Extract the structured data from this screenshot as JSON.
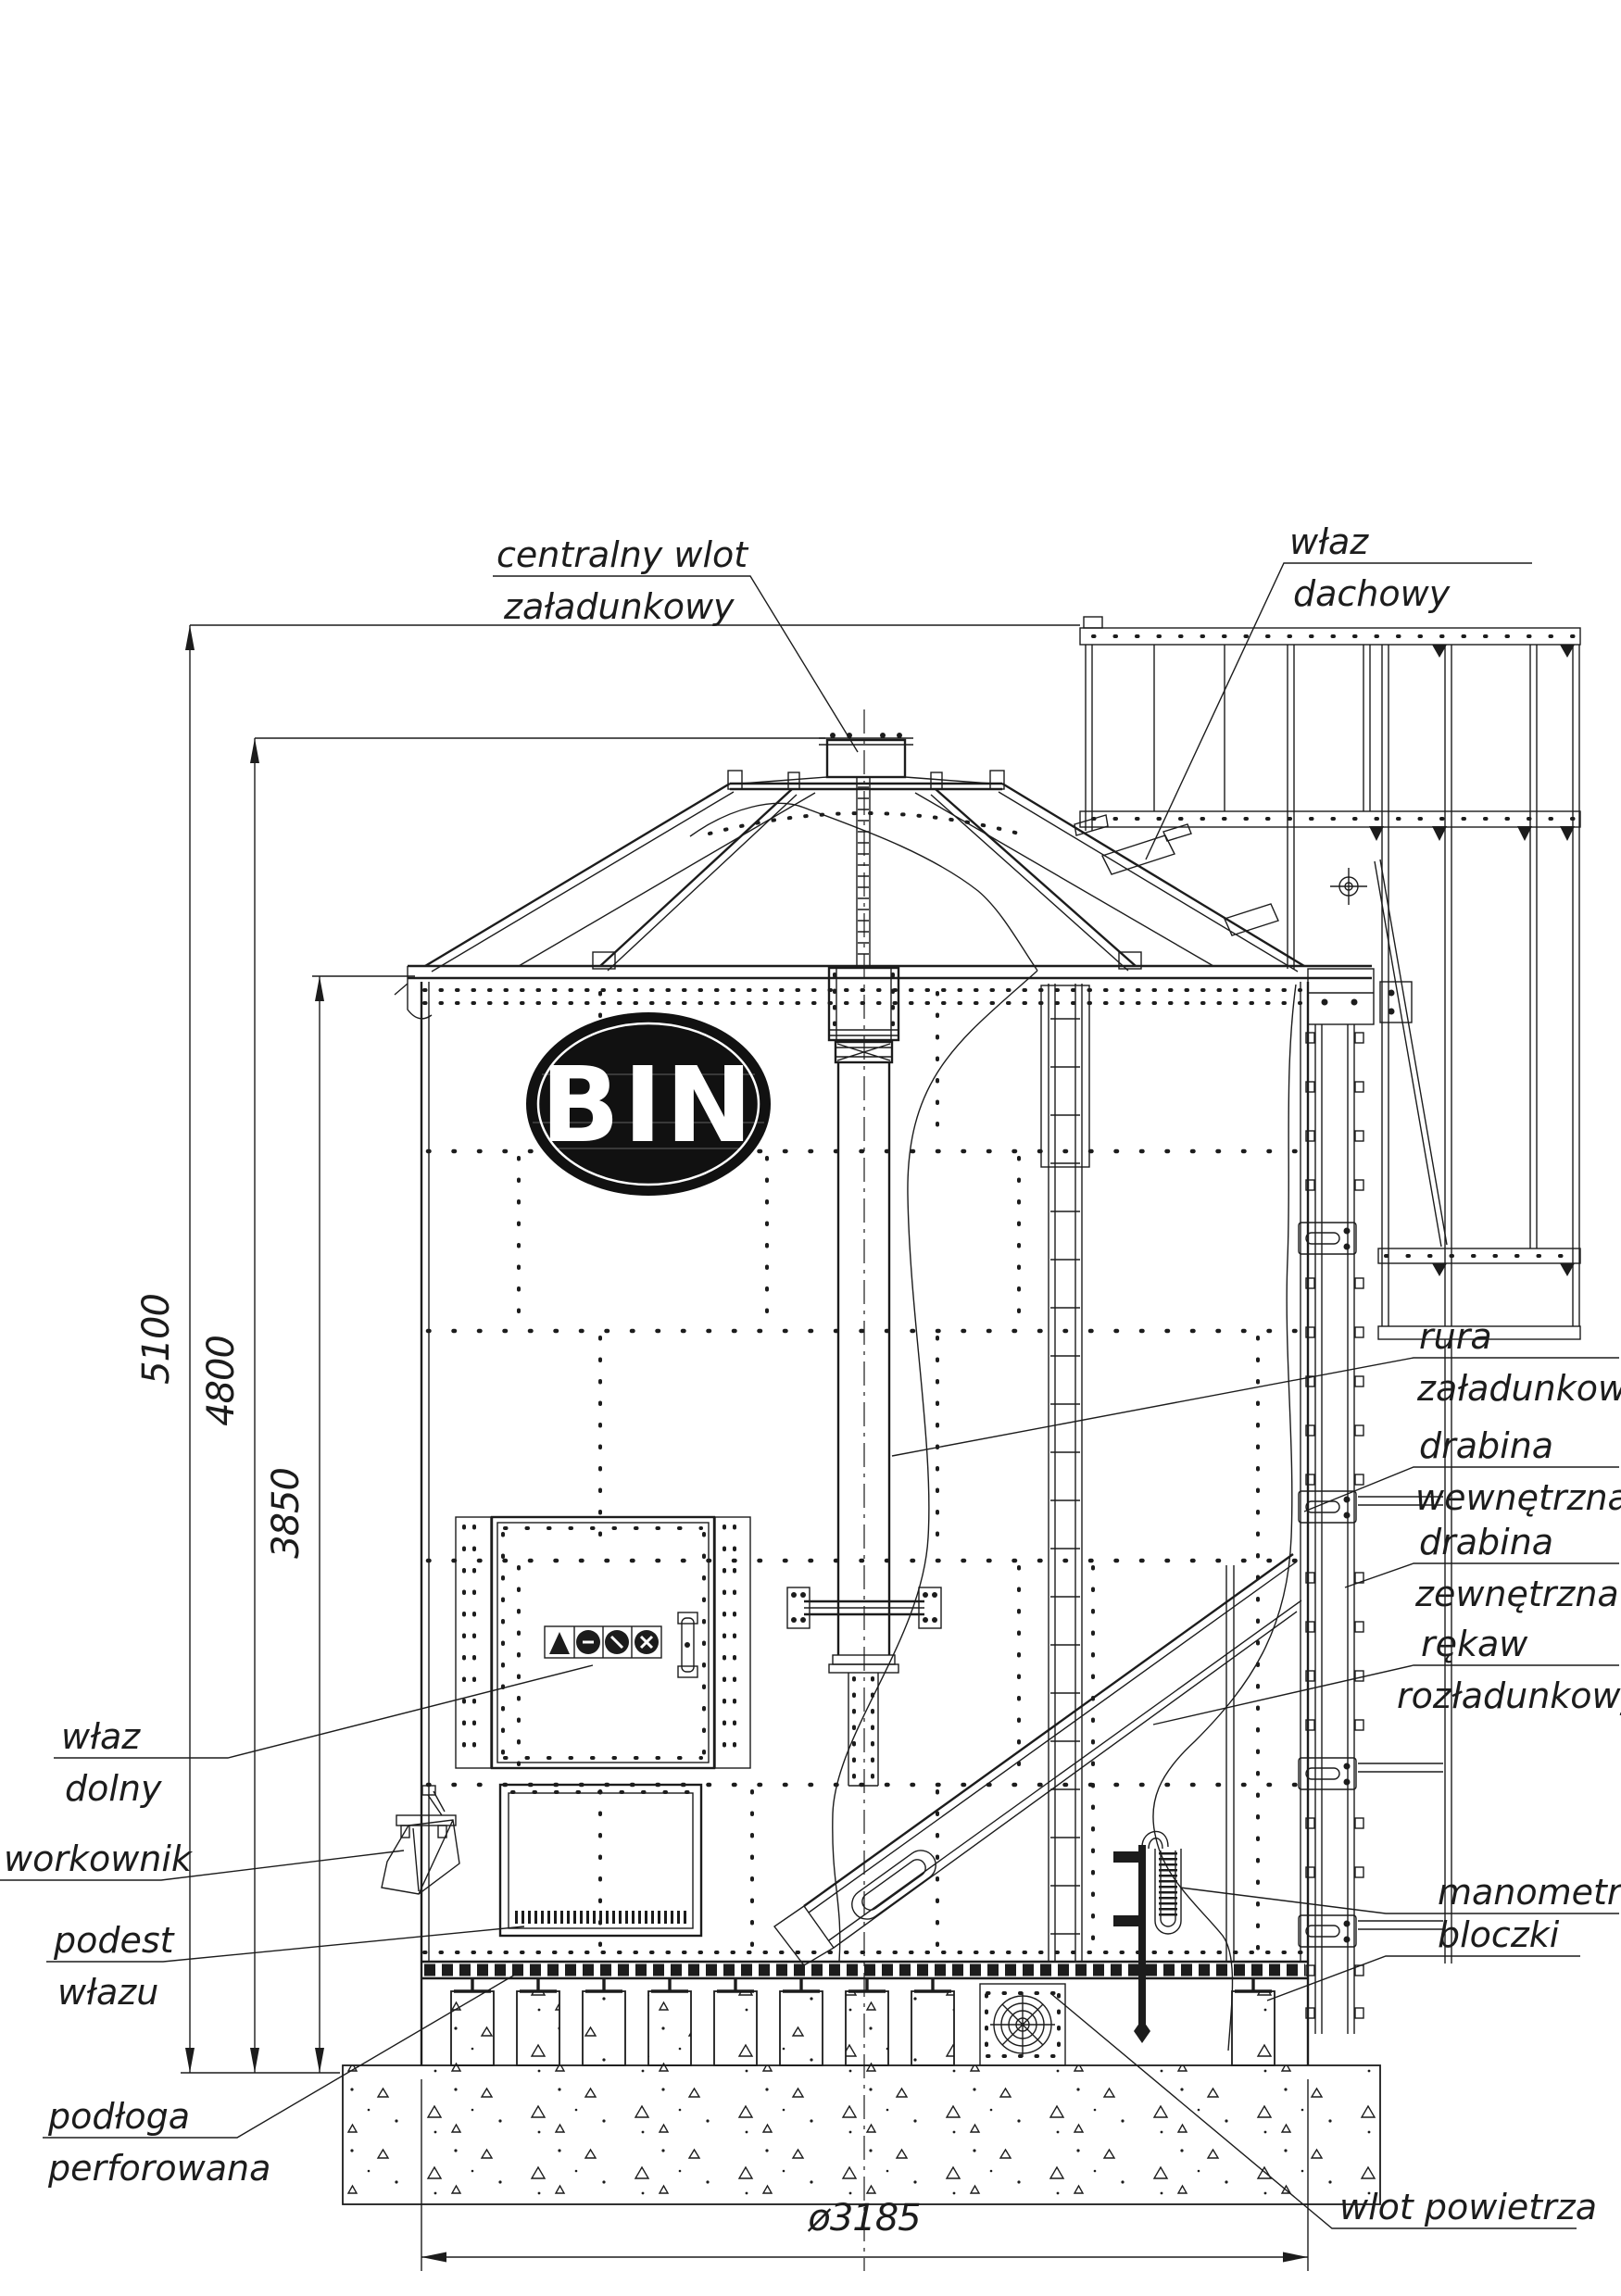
{
  "drawing": {
    "type": "technical-elevation-drawing",
    "subject": "BIN grain silo with dryer equipment, side elevation with partial cutaway",
    "logo_text": "BIN"
  },
  "labels": {
    "centralny_wlot": {
      "line1": "centralny wlot",
      "line2": "załadunkowy"
    },
    "wlaz_dachowy": {
      "line1": "właz",
      "line2": "dachowy"
    },
    "rura_zaladunkowa": {
      "line1": "rura",
      "line2": "załadunkowa"
    },
    "drabina_wewnetrzna": {
      "line1": "drabina",
      "line2": "wewnętrzna"
    },
    "drabina_zewnetrzna": {
      "line1": "drabina",
      "line2": "zewnętrzna"
    },
    "rekaw_rozladunkowy": {
      "line1": "rękaw",
      "line2": "rozładunkowy"
    },
    "manometr": {
      "line1": "manometr"
    },
    "bloczki": {
      "line1": "bloczki"
    },
    "wlot_powietrza": {
      "line1": "wlot powietrza"
    },
    "wlaz_dolny": {
      "line1": "właz",
      "line2": "dolny"
    },
    "workownik": {
      "line1": "workownik"
    },
    "podest_wlazu": {
      "line1": "podest",
      "line2": "włazu"
    },
    "podloga_perforowana": {
      "line1": "podłoga",
      "line2": "perforowana"
    }
  },
  "dimensions": {
    "total_height": "5100",
    "inlet_height": "4800",
    "eave_height": "3850",
    "diameter": "ø3185"
  },
  "icons": {
    "warning_strip": [
      "warning-triangle-icon",
      "hazard-circle-icon",
      "fan-hazard-icon",
      "blade-hazard-icon"
    ],
    "center_mark": "center-mark-icon",
    "air_inlet_grille": "fan-grille-icon"
  },
  "colors": {
    "line": "#1c1c1c",
    "background": "#ffffff",
    "logo": "#111111"
  }
}
